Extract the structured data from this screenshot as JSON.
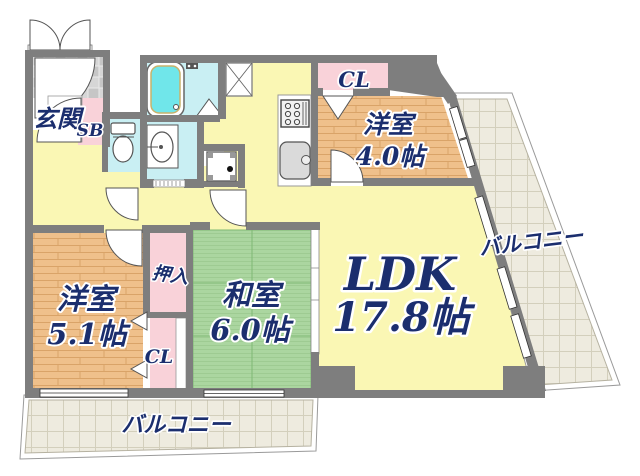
{
  "plan": {
    "entrance": {
      "label": "玄関",
      "shoe_box_label": "SB"
    },
    "closets": {
      "top_label": "CL",
      "bottom_label": "CL",
      "oshiire_label": "押入"
    },
    "rooms": {
      "western_small": {
        "name": "洋室",
        "size": "4.0帖"
      },
      "western_large": {
        "name": "洋室",
        "size": "5.1帖"
      },
      "japanese": {
        "name": "和室",
        "size": "6.0帖"
      },
      "ldk": {
        "name": "LDK",
        "size": "17.8帖"
      }
    },
    "balconies": {
      "right_label": "バルコニー",
      "bottom_label": "バルコニー"
    },
    "colors": {
      "wall": "#7e7e7e",
      "floor_yellow": "#faf7b4",
      "wood": "#efc08b",
      "tatami": "#abd6a0",
      "wet_area": "#c9eff3",
      "bath_water": "#70e6ea",
      "closet_pink": "#f9d2d9",
      "balcony": "#eeebdf",
      "label_navy": "#1b2e6e"
    }
  }
}
